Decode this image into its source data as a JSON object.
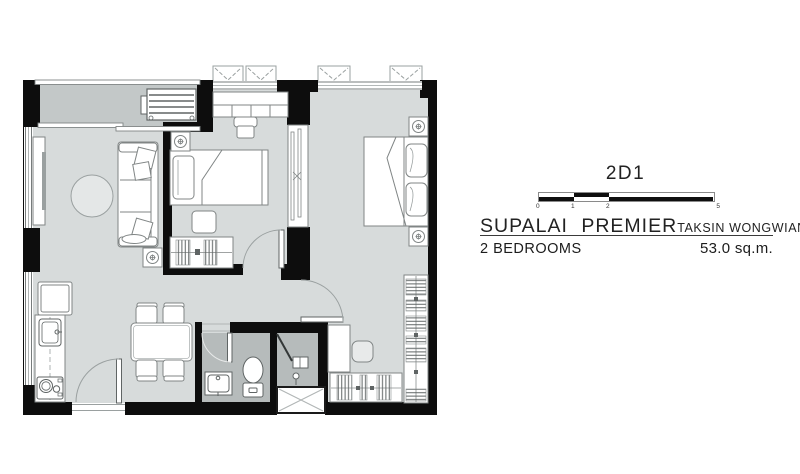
{
  "title_block": {
    "unit_type": "2D1",
    "project": "SUPALAI PREMIER",
    "location": "TAKSIN WONGWIANYAI",
    "bedrooms": "2 BEDROOMS",
    "area": "53.0 sq.m.",
    "scale_ticks": [
      "0",
      "1",
      "2",
      "5"
    ]
  },
  "floor_plan": {
    "rooms": [
      "balcony",
      "living-dining",
      "bedroom-2",
      "master-bedroom",
      "bathroom",
      "kitchen",
      "walk-in-wardrobe"
    ],
    "furniture_icons": [
      "air-conditioner-icon",
      "sofa-icon",
      "tv-console-icon",
      "round-rug-icon",
      "downlight-icon",
      "single-bed-icon",
      "wardrobe-icon",
      "desk-chair-icon",
      "drawer-chest-icon",
      "double-bed-icon",
      "walk-in-closet-icon",
      "pouf-icon",
      "dining-table-icon",
      "dining-chair-icon",
      "refrigerator-icon",
      "kitchen-sink-icon",
      "stove-icon",
      "vanity-sink-icon",
      "toilet-icon",
      "shower-icon",
      "door-swing-icon",
      "window-icon",
      "condenser-ledge-icon"
    ],
    "colors": {
      "wall": "#0d0d0d",
      "floor": "#d7dbdb",
      "balcony_floor": "#c3c8c8",
      "bathroom_floor": "#b6bbbb",
      "outline": "#808585",
      "hatch": "#5f6464"
    }
  }
}
